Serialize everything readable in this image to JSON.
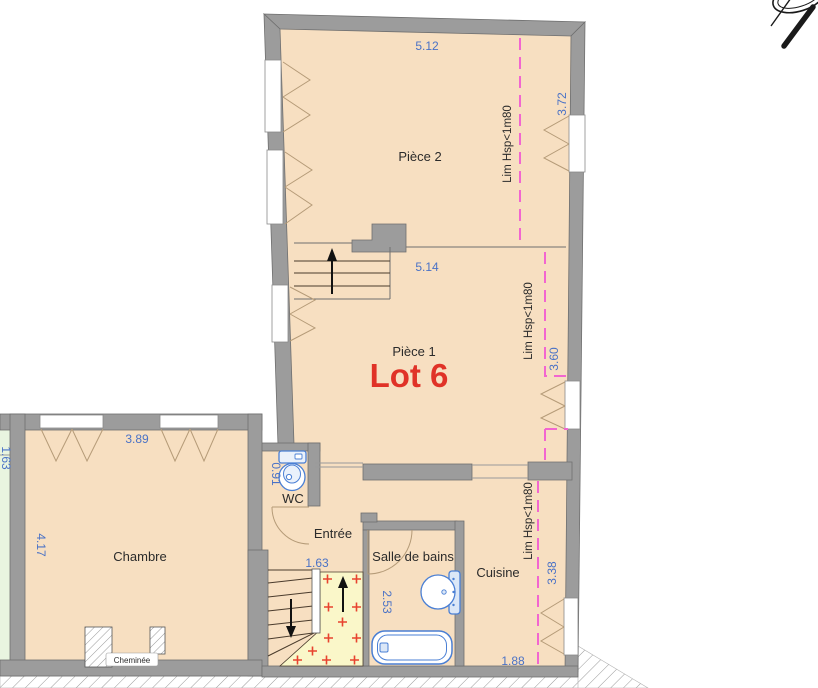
{
  "plan": {
    "type": "floor-plan",
    "lot_label": "Lot 6",
    "rooms": {
      "piece2": "Pièce 2",
      "piece1": "Pièce 1",
      "chambre": "Chambre",
      "wc": "WC",
      "entree": "Entrée",
      "salle_de_bains": "Salle de bains",
      "cuisine": "Cuisine",
      "cheminee": "Cheminée"
    },
    "dimensions": {
      "piece2_width": "5.12",
      "piece2_depth": "3.72",
      "piece1_width": "5.14",
      "piece1_depth": "3.60",
      "chambre_width": "3.89",
      "chambre_depth": "4.17",
      "wc_depth": "0.91",
      "stair_width": "1.63",
      "salle_de_bains_depth": "2.53",
      "cuisine_depth": "3.38",
      "cuisine_width": "1.88",
      "left_edge_clipped": "1.63"
    },
    "limit_label": "Lim Hsp<1m80",
    "colors": {
      "wall_gray": "#9c9c9c",
      "wall_outline": "#6f6f6f",
      "room_fill": "#f7dfc1",
      "green_room_fill": "#e9f5e0",
      "landing_fill": "#faf7c9",
      "dimension_blue": "#4a72c6",
      "limit_pink": "#f266d0",
      "lot_red": "#e03227",
      "cross_red": "#e8432f",
      "fixture_blue": "#4a7fd4",
      "stair_line": "#4a3b2c",
      "door_tan": "#b59b78"
    }
  }
}
